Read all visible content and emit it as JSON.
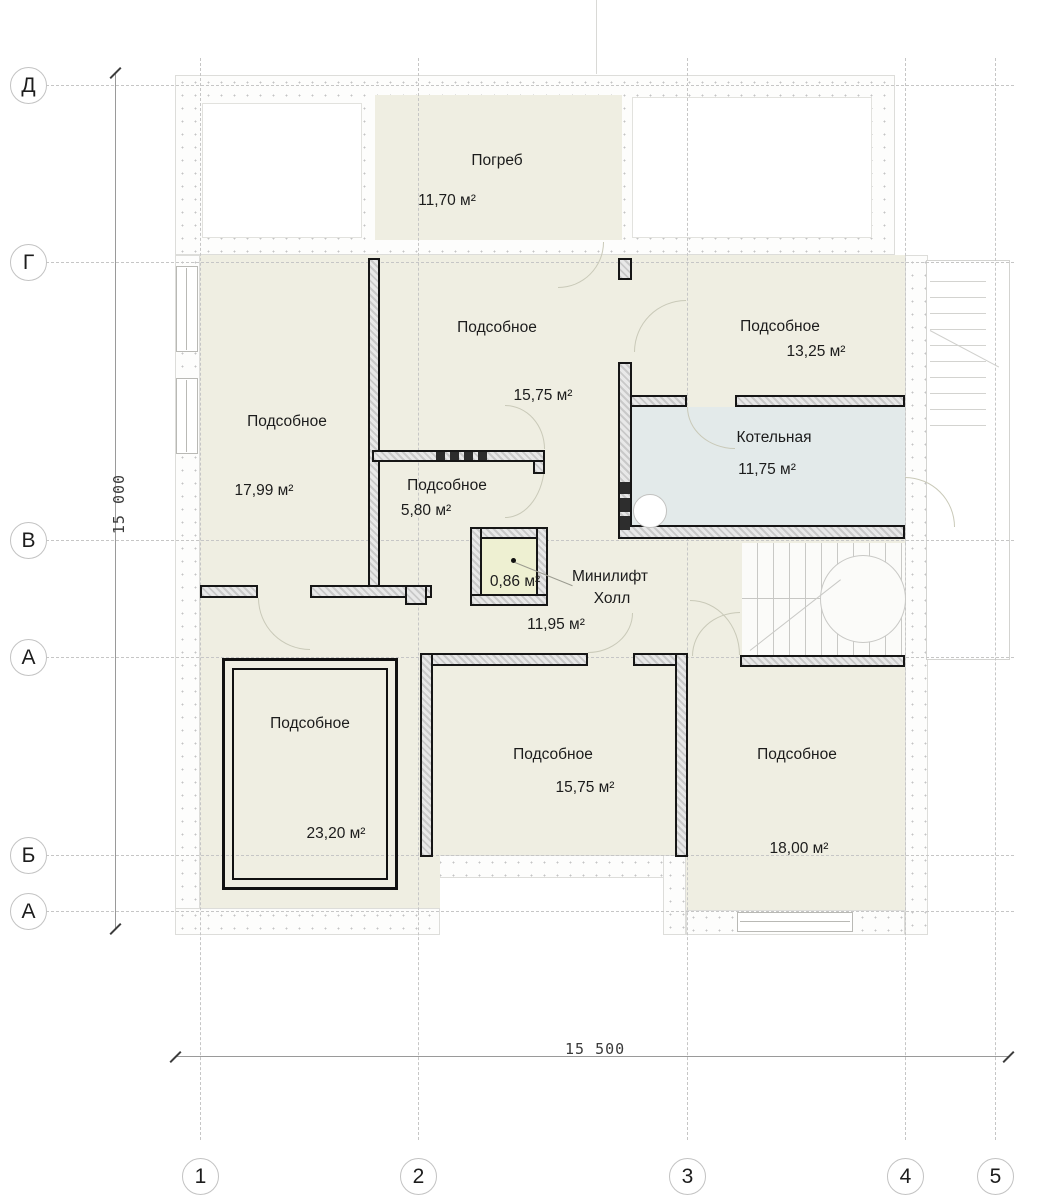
{
  "axes": {
    "rows": [
      "Д",
      "Г",
      "В",
      "А",
      "Б",
      "А"
    ],
    "cols": [
      "1",
      "2",
      "3",
      "4",
      "5"
    ]
  },
  "dimensions": {
    "vertical": "15 000",
    "horizontal": "15 500"
  },
  "rooms": [
    {
      "name": "Погреб",
      "area": "11,70 м²"
    },
    {
      "name": "Подсобное",
      "area": "15,75 м²"
    },
    {
      "name": "Подсобное",
      "area": "13,25 м²"
    },
    {
      "name": "Котельная",
      "area": "11,75 м²"
    },
    {
      "name": "Подсобное",
      "area": "17,99 м²"
    },
    {
      "name": "Подсобное",
      "area": "5,80 м²"
    },
    {
      "name": "Минилифт",
      "area": "0,86 м²"
    },
    {
      "name": "Холл",
      "area": "11,95 м²"
    },
    {
      "name": "Подсобное",
      "area": "23,20 м²"
    },
    {
      "name": "Подсобное",
      "area": "15,75 м²"
    },
    {
      "name": "Подсобное",
      "area": "18,00 м²"
    }
  ],
  "colors": {
    "room_fill": "#efeee2",
    "boiler_fill": "#e3eaea",
    "minilift_fill": "#eef0d2",
    "wall_outline": "#161616"
  }
}
